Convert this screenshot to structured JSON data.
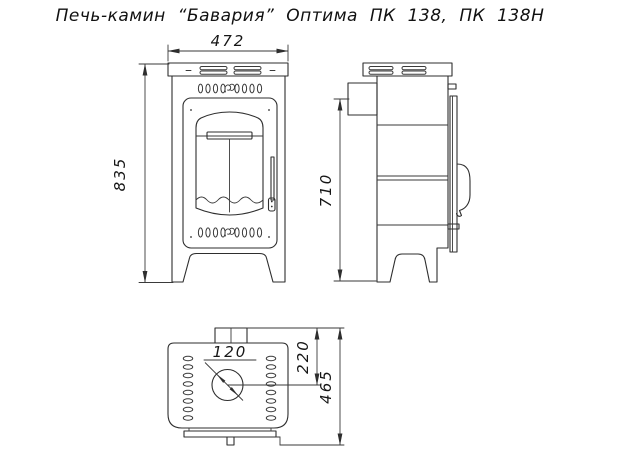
{
  "title": "Печь-камин “Бавария” Оптима ПК 138, ПК 138Н",
  "drawing": {
    "type": "technical-drawing",
    "views": {
      "front": {
        "name": "вид спереди (front view)",
        "dimensions": {
          "width_mm": "472",
          "height_mm": "835"
        }
      },
      "side": {
        "name": "вид сбоку (side view)",
        "dimensions": {
          "flue_center_height_mm": "710"
        }
      },
      "top": {
        "name": "вид сверху (top view)",
        "dimensions": {
          "flue_diameter_mm": "120",
          "flue_center_from_rear_mm": "220",
          "depth_mm": "465"
        }
      }
    }
  },
  "labels": {
    "front_width": "472",
    "front_height": "835",
    "side_flue_height": "710",
    "flue_diameter": "120",
    "flue_offset": "220",
    "depth": "465"
  },
  "colors": {
    "background": "#ffffff",
    "line": "#2e2e2e",
    "text": "#161616"
  }
}
